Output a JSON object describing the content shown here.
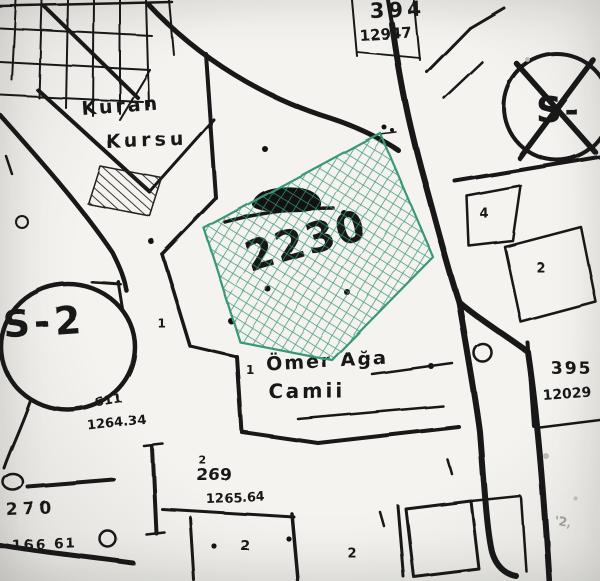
{
  "colors": {
    "paper": "#eceae6",
    "ink": "#1d1d1d",
    "highlight": "#3c9678"
  },
  "highlight": {
    "parcel_number": "2230"
  },
  "labels": {
    "parcel_394": {
      "number": "394",
      "area": "12947"
    },
    "parcel_395": {
      "number": "395",
      "area": "12029"
    },
    "kuran_kursu": {
      "line1": "Kuran",
      "line2": "Kursu"
    },
    "mosque": {
      "line1": "Ömer Ağa",
      "line2": "Camii"
    },
    "zone_left": "S-2",
    "zone_right": "S-",
    "parcel_611": {
      "number": "611",
      "area": "1264.34"
    },
    "parcel_269": {
      "number": "269",
      "superscript": "2",
      "area": "1265.64"
    },
    "parcel_270": {
      "number": "270",
      "area": "166 61"
    },
    "lot_numbers": {
      "a": "4",
      "b": "2",
      "c": "1",
      "d": "1",
      "e": "2",
      "f": "2",
      "g": "'2,"
    }
  }
}
